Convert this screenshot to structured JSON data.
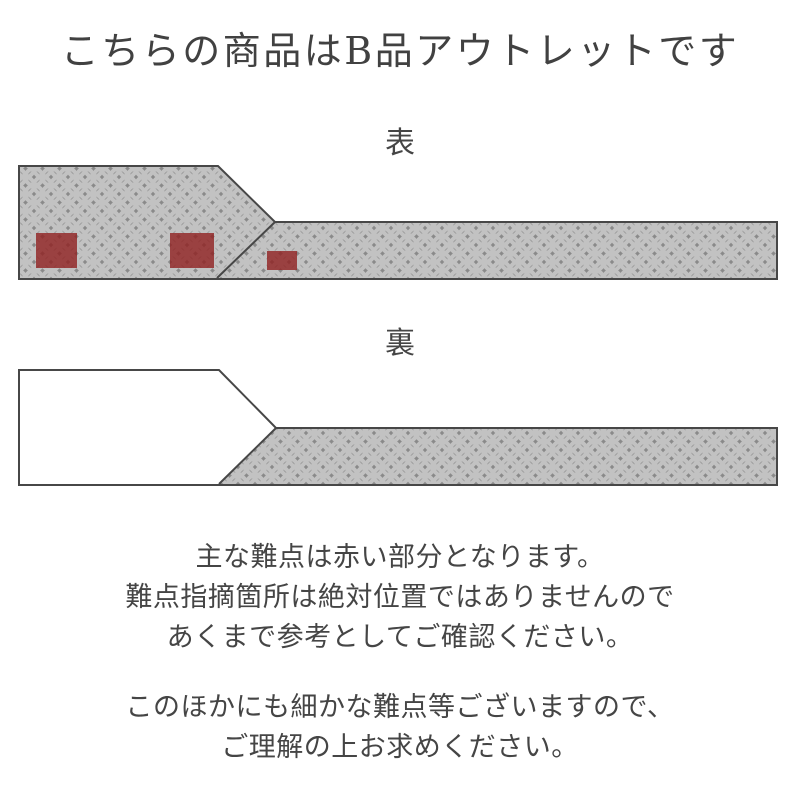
{
  "title": "こちらの商品はB品アウトレットです",
  "front": {
    "label": "表",
    "defects": [
      {
        "x": 36,
        "y": 73,
        "w": 41,
        "h": 35
      },
      {
        "x": 170,
        "y": 73,
        "w": 44,
        "h": 35
      },
      {
        "x": 267,
        "y": 91,
        "w": 30,
        "h": 19
      }
    ]
  },
  "back": {
    "label": "裏"
  },
  "notes": {
    "block1": [
      "主な難点は赤い部分となります。",
      "難点指摘箇所は絶対位置ではありませんので",
      "あくまで参考としてご確認ください。"
    ],
    "block2": [
      "このほかにも細かな難点等ございますので、",
      "ご理解の上お求めください。"
    ]
  },
  "colors": {
    "background": "#ffffff",
    "text": "#454545",
    "outline": "#474747",
    "pattern_base": "#9b9b9b",
    "pattern_ring": "#c2c2c2",
    "pattern_diamond": "#8a8a8a",
    "defect_red": "#902020",
    "back_plain": "#ffffff"
  }
}
